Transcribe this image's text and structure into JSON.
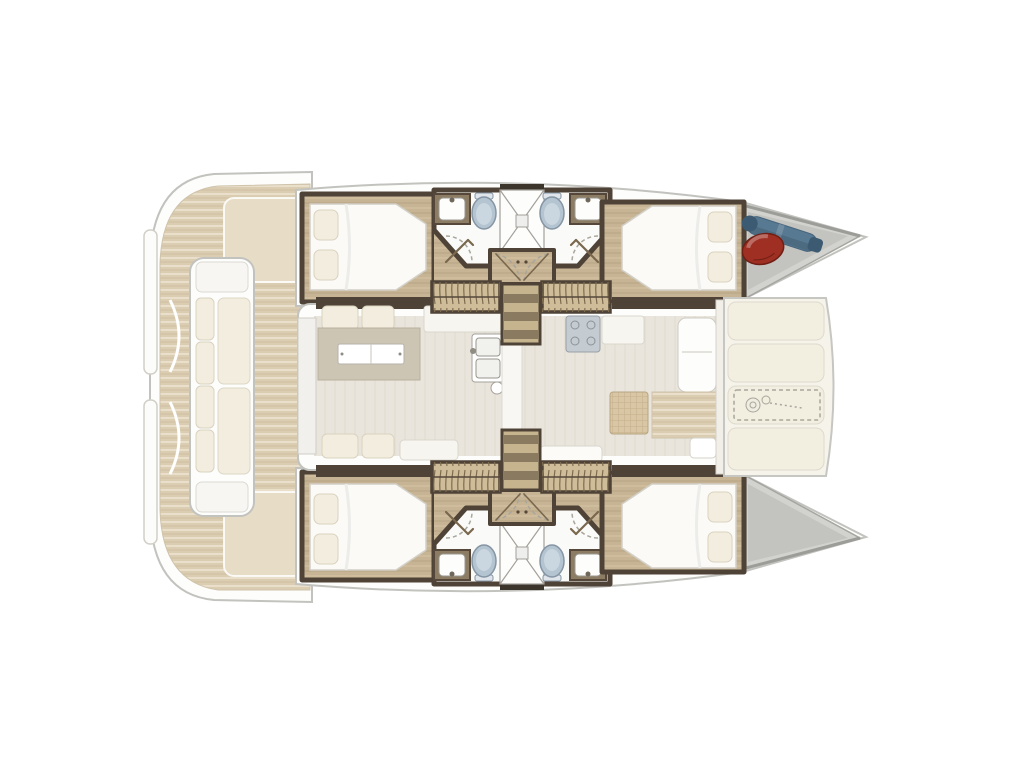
{
  "diagram": {
    "type": "boat-floor-plan",
    "subject": "catamaran-interior-layout",
    "orientation": "bow-right",
    "features": [
      "aft-cockpit-lounge",
      "salon-with-galley-and-dinette",
      "four-double-cabins",
      "four-bathrooms",
      "central-shower-stalls",
      "companionway-stairs",
      "foredeck-sunpads",
      "anchor-windlass-hatch",
      "bow-storage-lockers",
      "red-fender",
      "blue-gear-bag"
    ],
    "counts": {
      "cabins": 4,
      "double_beds": 4,
      "bathrooms": 4,
      "toilets": 4,
      "sinks": 4,
      "shower_stalls": 2,
      "stair_sets": 2,
      "sunpad_panels": 4
    }
  },
  "colors": {
    "background": "#ffffff",
    "hull_white": "#fdfdfc",
    "outline_gray": "#c2c2be",
    "teak": "#dbcdb1",
    "plank": "#c7b494",
    "louver": "#cfbd99",
    "step_light": "#c6b48f",
    "step_dark": "#8a7a5f",
    "wall": "#4e4336",
    "salon_floor": "#e9e5dc",
    "table": "#cdc5b3",
    "counter": "#f7f5ef",
    "toilet": "#b5c4d1",
    "stove": "#c4cbd1",
    "mat": "#d9c6a4",
    "cushion": "#f2edde",
    "sunpad": "#f2eee0",
    "hatch": "#e7ddc7",
    "locker": "#d2d2cf",
    "locker_inner": "#c3c3c0",
    "fender_red": "#9e2f22",
    "gear_bag_blue": "#577992"
  }
}
